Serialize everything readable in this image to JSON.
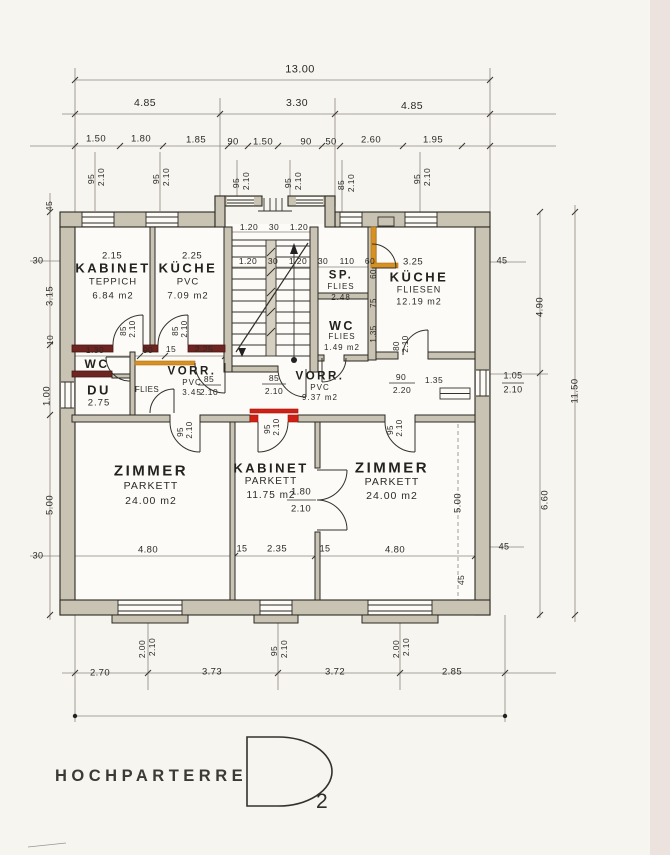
{
  "title": {
    "label": "HOCHPARTERRE",
    "variant_letter": "D",
    "variant_number": "2"
  },
  "colors": {
    "paper": "#f7f5f0",
    "wall_fill": "#c9c3b4",
    "highlight_maroon": "#6e2420",
    "highlight_red": "#d02015",
    "highlight_orange": "#d79022",
    "linework": "#2b2922"
  },
  "plan": {
    "rooms": [
      {
        "name": "KABINET",
        "floor": "TEPPICH",
        "area": "6.84 m2",
        "x": 113,
        "y": 268,
        "ns": 13,
        "ss": 9.5,
        "lh": 14
      },
      {
        "name": "KÜCHE",
        "floor": "PVC",
        "area": "7.09 m2",
        "x": 188,
        "y": 268,
        "ns": 13,
        "ss": 9.5,
        "lh": 14
      },
      {
        "name": "SP.",
        "floor": "FLIES",
        "area": "2.48",
        "x": 341,
        "y": 276,
        "ns": 11.5,
        "ss": 8,
        "lh": 11
      },
      {
        "name": "WC",
        "floor": "FLIES",
        "area": "1.49 m2",
        "x": 342,
        "y": 326,
        "ns": 12.5,
        "ss": 8,
        "lh": 11
      },
      {
        "name": "KÜCHE",
        "floor": "FLIESEN",
        "area": "12.19 m2",
        "x": 419,
        "y": 277,
        "ns": 13,
        "ss": 9,
        "lh": 12.5
      },
      {
        "name": "WC",
        "floor": null,
        "area": null,
        "x": 97,
        "y": 364,
        "ns": 12,
        "ss": 9,
        "lh": 12
      },
      {
        "name": "DU",
        "floor": null,
        "area": "2.75",
        "x": 99,
        "y": 390,
        "ns": 13,
        "ss": 9.5,
        "lh": 13
      },
      {
        "name": "VORR.",
        "floor": "PVC",
        "area": "3.45",
        "x": 192,
        "y": 372,
        "ns": 11.5,
        "ss": 8,
        "lh": 10.5
      },
      {
        "name": "VORR.",
        "floor": "PVC",
        "area": "9.37 m2",
        "x": 320,
        "y": 377,
        "ns": 11.5,
        "ss": 8,
        "lh": 10.5
      },
      {
        "name": "ZIMMER",
        "floor": "PARKETT",
        "area": "24.00 m2",
        "x": 151,
        "y": 471,
        "ns": 15,
        "ss": 10.5,
        "lh": 15
      },
      {
        "name": "KABINET",
        "floor": "PARKETT",
        "area": "11.75 m2",
        "x": 271,
        "y": 468,
        "ns": 13,
        "ss": 10,
        "lh": 14
      },
      {
        "name": "ZIMMER",
        "floor": "PARKETT",
        "area": "24.00 m2",
        "x": 392,
        "y": 468,
        "ns": 15,
        "ss": 10.5,
        "lh": 14
      }
    ],
    "dims": [
      {
        "t": "13.00",
        "x": 300,
        "y": 70,
        "s": 11
      },
      {
        "t": "4.85",
        "x": 145,
        "y": 103,
        "s": 10.5
      },
      {
        "t": "3.30",
        "x": 297,
        "y": 103,
        "s": 10.5
      },
      {
        "t": "4.85",
        "x": 412,
        "y": 106,
        "s": 10.5
      },
      {
        "t": "1.50",
        "x": 96,
        "y": 139
      },
      {
        "t": "1.80",
        "x": 141,
        "y": 139
      },
      {
        "t": "1.85",
        "x": 196,
        "y": 140
      },
      {
        "t": "90",
        "x": 233,
        "y": 142
      },
      {
        "t": "1.50",
        "x": 263,
        "y": 142
      },
      {
        "t": "90",
        "x": 306,
        "y": 142
      },
      {
        "t": "50",
        "x": 331,
        "y": 142
      },
      {
        "t": "2.60",
        "x": 371,
        "y": 140
      },
      {
        "t": "1.95",
        "x": 433,
        "y": 140
      },
      {
        "t": "95",
        "x": 91,
        "y": 179,
        "r": -90,
        "s": 8.5
      },
      {
        "t": "2.10",
        "x": 101,
        "y": 177,
        "r": -90,
        "s": 8.5
      },
      {
        "t": "95",
        "x": 156,
        "y": 179,
        "r": -90,
        "s": 8.5
      },
      {
        "t": "2.10",
        "x": 166,
        "y": 177,
        "r": -90,
        "s": 8.5
      },
      {
        "t": "95",
        "x": 236,
        "y": 183,
        "r": -90,
        "s": 8.5
      },
      {
        "t": "2.10",
        "x": 246,
        "y": 181,
        "r": -90,
        "s": 8.5
      },
      {
        "t": "95",
        "x": 288,
        "y": 183,
        "r": -90,
        "s": 8.5
      },
      {
        "t": "2.10",
        "x": 298,
        "y": 181,
        "r": -90,
        "s": 8.5
      },
      {
        "t": "85",
        "x": 341,
        "y": 185,
        "r": -90,
        "s": 8.5
      },
      {
        "t": "2.10",
        "x": 351,
        "y": 183,
        "r": -90,
        "s": 8.5
      },
      {
        "t": "95",
        "x": 417,
        "y": 179,
        "r": -90,
        "s": 8.5
      },
      {
        "t": "2.10",
        "x": 427,
        "y": 177,
        "r": -90,
        "s": 8.5
      },
      {
        "t": "45",
        "x": 49,
        "y": 206,
        "r": -90,
        "s": 8.5
      },
      {
        "t": "30",
        "x": 38,
        "y": 261,
        "s": 9
      },
      {
        "t": "3.15",
        "x": 50,
        "y": 296,
        "r": -90
      },
      {
        "t": "10",
        "x": 50,
        "y": 340,
        "r": -90,
        "s": 8.5
      },
      {
        "t": "1.00",
        "x": 47,
        "y": 396,
        "r": -90
      },
      {
        "t": "5.00",
        "x": 50,
        "y": 505,
        "r": -90
      },
      {
        "t": "30",
        "x": 38,
        "y": 556,
        "s": 9
      },
      {
        "t": "45",
        "x": 502,
        "y": 261,
        "s": 9
      },
      {
        "t": "4.90",
        "x": 540,
        "y": 307,
        "r": -90
      },
      {
        "t": "11.50",
        "x": 575,
        "y": 391,
        "r": -90
      },
      {
        "t": "1.05",
        "x": 513,
        "y": 376,
        "s": 9
      },
      {
        "t": "2.10",
        "x": 513,
        "y": 390,
        "s": 9
      },
      {
        "t": "6.60",
        "x": 545,
        "y": 500,
        "r": -90
      },
      {
        "t": "45",
        "x": 504,
        "y": 547,
        "s": 9
      },
      {
        "t": "5.00",
        "x": 458,
        "y": 503,
        "r": -90
      },
      {
        "t": "45",
        "x": 461,
        "y": 580,
        "r": -90,
        "s": 8.5
      },
      {
        "t": "2.15",
        "x": 112,
        "y": 256
      },
      {
        "t": "2.25",
        "x": 192,
        "y": 256
      },
      {
        "t": "3.25",
        "x": 413,
        "y": 262
      },
      {
        "t": "1.20",
        "x": 249,
        "y": 227,
        "s": 8.5
      },
      {
        "t": "30",
        "x": 274,
        "y": 227,
        "s": 8.5
      },
      {
        "t": "1.20",
        "x": 299,
        "y": 227,
        "s": 8.5
      },
      {
        "t": "1.20",
        "x": 248,
        "y": 261,
        "s": 8.5
      },
      {
        "t": "30",
        "x": 273,
        "y": 261,
        "s": 8.5
      },
      {
        "t": "1.20",
        "x": 298,
        "y": 261,
        "s": 8.5
      },
      {
        "t": "30",
        "x": 323,
        "y": 261,
        "s": 8.5
      },
      {
        "t": "110",
        "x": 347,
        "y": 261,
        "s": 8.5
      },
      {
        "t": "60",
        "x": 370,
        "y": 261,
        "s": 8.5
      },
      {
        "t": "1.30",
        "x": 95,
        "y": 350,
        "s": 8.5
      },
      {
        "t": "90",
        "x": 148,
        "y": 350,
        "s": 8.5
      },
      {
        "t": "15",
        "x": 171,
        "y": 349,
        "s": 8.5
      },
      {
        "t": "2.25",
        "x": 204,
        "y": 349,
        "s": 8.5
      },
      {
        "t": "85",
        "x": 124,
        "y": 331,
        "r": -90,
        "s": 8
      },
      {
        "t": "2.10",
        "x": 133,
        "y": 329,
        "r": -90,
        "s": 8
      },
      {
        "t": "85",
        "x": 176,
        "y": 331,
        "r": -90,
        "s": 8
      },
      {
        "t": "2.10",
        "x": 185,
        "y": 329,
        "r": -90,
        "s": 8
      },
      {
        "t": "85",
        "x": 209,
        "y": 379,
        "s": 8.5
      },
      {
        "t": "2.10",
        "x": 209,
        "y": 392,
        "s": 8.5
      },
      {
        "t": "85",
        "x": 274,
        "y": 378,
        "s": 8.5
      },
      {
        "t": "2.10",
        "x": 274,
        "y": 391,
        "s": 8.5
      },
      {
        "t": "90",
        "x": 401,
        "y": 377,
        "s": 8.5
      },
      {
        "t": "2.20",
        "x": 402,
        "y": 390,
        "s": 8.5
      },
      {
        "t": "1.35",
        "x": 434,
        "y": 380,
        "s": 8.5
      },
      {
        "t": "FLIES",
        "x": 147,
        "y": 390,
        "s": 8
      },
      {
        "t": "60",
        "x": 374,
        "y": 274,
        "r": -90,
        "s": 8
      },
      {
        "t": "75",
        "x": 374,
        "y": 303,
        "r": -90,
        "s": 8
      },
      {
        "t": "1.35",
        "x": 374,
        "y": 334,
        "r": -90,
        "s": 8
      },
      {
        "t": "80",
        "x": 397,
        "y": 346,
        "r": -90,
        "s": 8
      },
      {
        "t": "2.10",
        "x": 406,
        "y": 344,
        "r": -90,
        "s": 8
      },
      {
        "t": "95",
        "x": 181,
        "y": 432,
        "r": -90,
        "s": 8
      },
      {
        "t": "2.10",
        "x": 190,
        "y": 430,
        "r": -90,
        "s": 8
      },
      {
        "t": "95",
        "x": 268,
        "y": 429,
        "r": -90,
        "s": 8
      },
      {
        "t": "2.10",
        "x": 277,
        "y": 427,
        "r": -90,
        "s": 8
      },
      {
        "t": "95",
        "x": 391,
        "y": 430,
        "r": -90,
        "s": 8
      },
      {
        "t": "2.10",
        "x": 400,
        "y": 428,
        "r": -90,
        "s": 8
      },
      {
        "t": "1.80",
        "x": 301,
        "y": 492,
        "s": 9.5
      },
      {
        "t": "2.10",
        "x": 301,
        "y": 509,
        "s": 9.5
      },
      {
        "t": "4.80",
        "x": 148,
        "y": 550
      },
      {
        "t": "15",
        "x": 242,
        "y": 549,
        "s": 9
      },
      {
        "t": "2.35",
        "x": 277,
        "y": 549
      },
      {
        "t": "15",
        "x": 325,
        "y": 549,
        "s": 9
      },
      {
        "t": "4.80",
        "x": 395,
        "y": 550
      },
      {
        "t": "2.00",
        "x": 142,
        "y": 649,
        "r": -90,
        "s": 8.5
      },
      {
        "t": "2.10",
        "x": 152,
        "y": 647,
        "r": -90,
        "s": 8.5
      },
      {
        "t": "95",
        "x": 274,
        "y": 651,
        "r": -90,
        "s": 8.5
      },
      {
        "t": "2.10",
        "x": 284,
        "y": 649,
        "r": -90,
        "s": 8.5
      },
      {
        "t": "2.00",
        "x": 396,
        "y": 649,
        "r": -90,
        "s": 8.5
      },
      {
        "t": "2.10",
        "x": 406,
        "y": 647,
        "r": -90,
        "s": 8.5
      },
      {
        "t": "2.70",
        "x": 100,
        "y": 673
      },
      {
        "t": "3.73",
        "x": 212,
        "y": 672
      },
      {
        "t": "3.72",
        "x": 335,
        "y": 672
      },
      {
        "t": "2.85",
        "x": 452,
        "y": 672
      }
    ]
  }
}
